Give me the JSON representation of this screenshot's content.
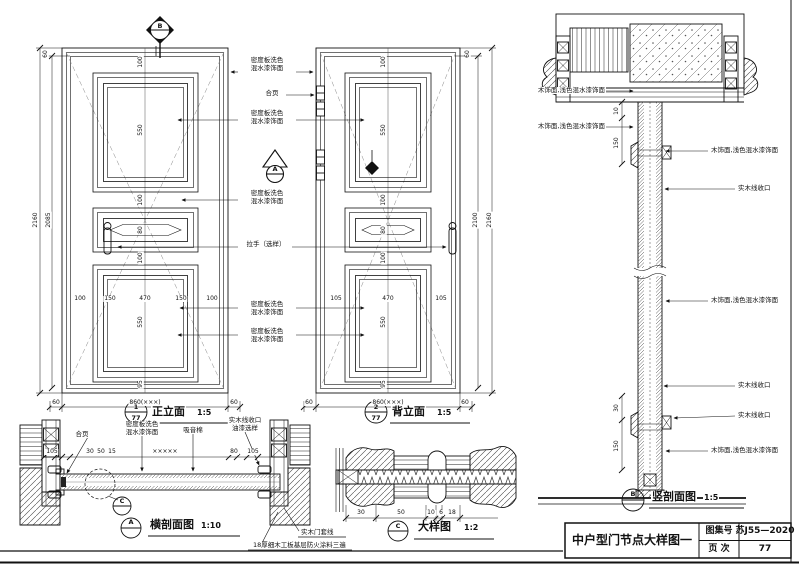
{
  "sheet": {
    "drawing_title": "中户型门节点大样图一",
    "atlas_label": "图集号",
    "atlas_value": "苏J55—2020",
    "page_label": "页 次",
    "page_value": "77"
  },
  "materials": {
    "mdf_line1": "密度板洗色",
    "mdf_line2": "混水漆饰面",
    "hinge": "合页",
    "handle": "拉手（选样）",
    "absorbent": "吸音棉",
    "trim_line1": "实木线收口",
    "trim_line2": "油漆选样",
    "wood_finish": "木饰面,浅色混水漆饰面",
    "solid_trim": "实木线收口",
    "casing": "实木门套线",
    "base_layer": "18厚细木工板基层防火涂料三遍"
  },
  "markers": {
    "section_b": "B",
    "section_a": "A"
  },
  "front_elevation": {
    "label": "正立面",
    "scale": "1:5",
    "bubble_no": "1",
    "bubble_page": "77",
    "dim_height_outer": "2160",
    "dim_height_inner": "2085",
    "dim_top": "60",
    "dim_bottom": [
      "60",
      "860(×××)",
      "60"
    ],
    "panel_row": [
      "100",
      "150",
      "470",
      "150",
      "100"
    ],
    "center_dims": [
      "100",
      "550",
      "100",
      "80",
      "100",
      "550",
      "95"
    ]
  },
  "back_elevation": {
    "label": "背立面",
    "scale": "1:5",
    "bubble_no": "2",
    "bubble_page": "77",
    "dim_height_inner": "2100",
    "dim_height_outer": "2160",
    "dim_top": "60",
    "dim_bottom": [
      "60",
      "860(×××)",
      "60"
    ],
    "panel_row": [
      "105",
      "470",
      "105"
    ]
  },
  "horizontal_section": {
    "label": "横剖面图",
    "scale": "1:10",
    "bubble": "A",
    "detail_bubble": "C",
    "dims": [
      "105",
      "30",
      "50",
      "15",
      "×××××",
      "80",
      "105"
    ]
  },
  "detail_view": {
    "label": "大样图",
    "scale": "1:2",
    "bubble": "C",
    "dims": [
      "30",
      "50",
      "10",
      "6",
      "18"
    ]
  },
  "vertical_section": {
    "label": "竖剖面图",
    "scale": "1:5",
    "bubble": "B",
    "dims": [
      "10",
      "150",
      "30",
      "150"
    ]
  }
}
